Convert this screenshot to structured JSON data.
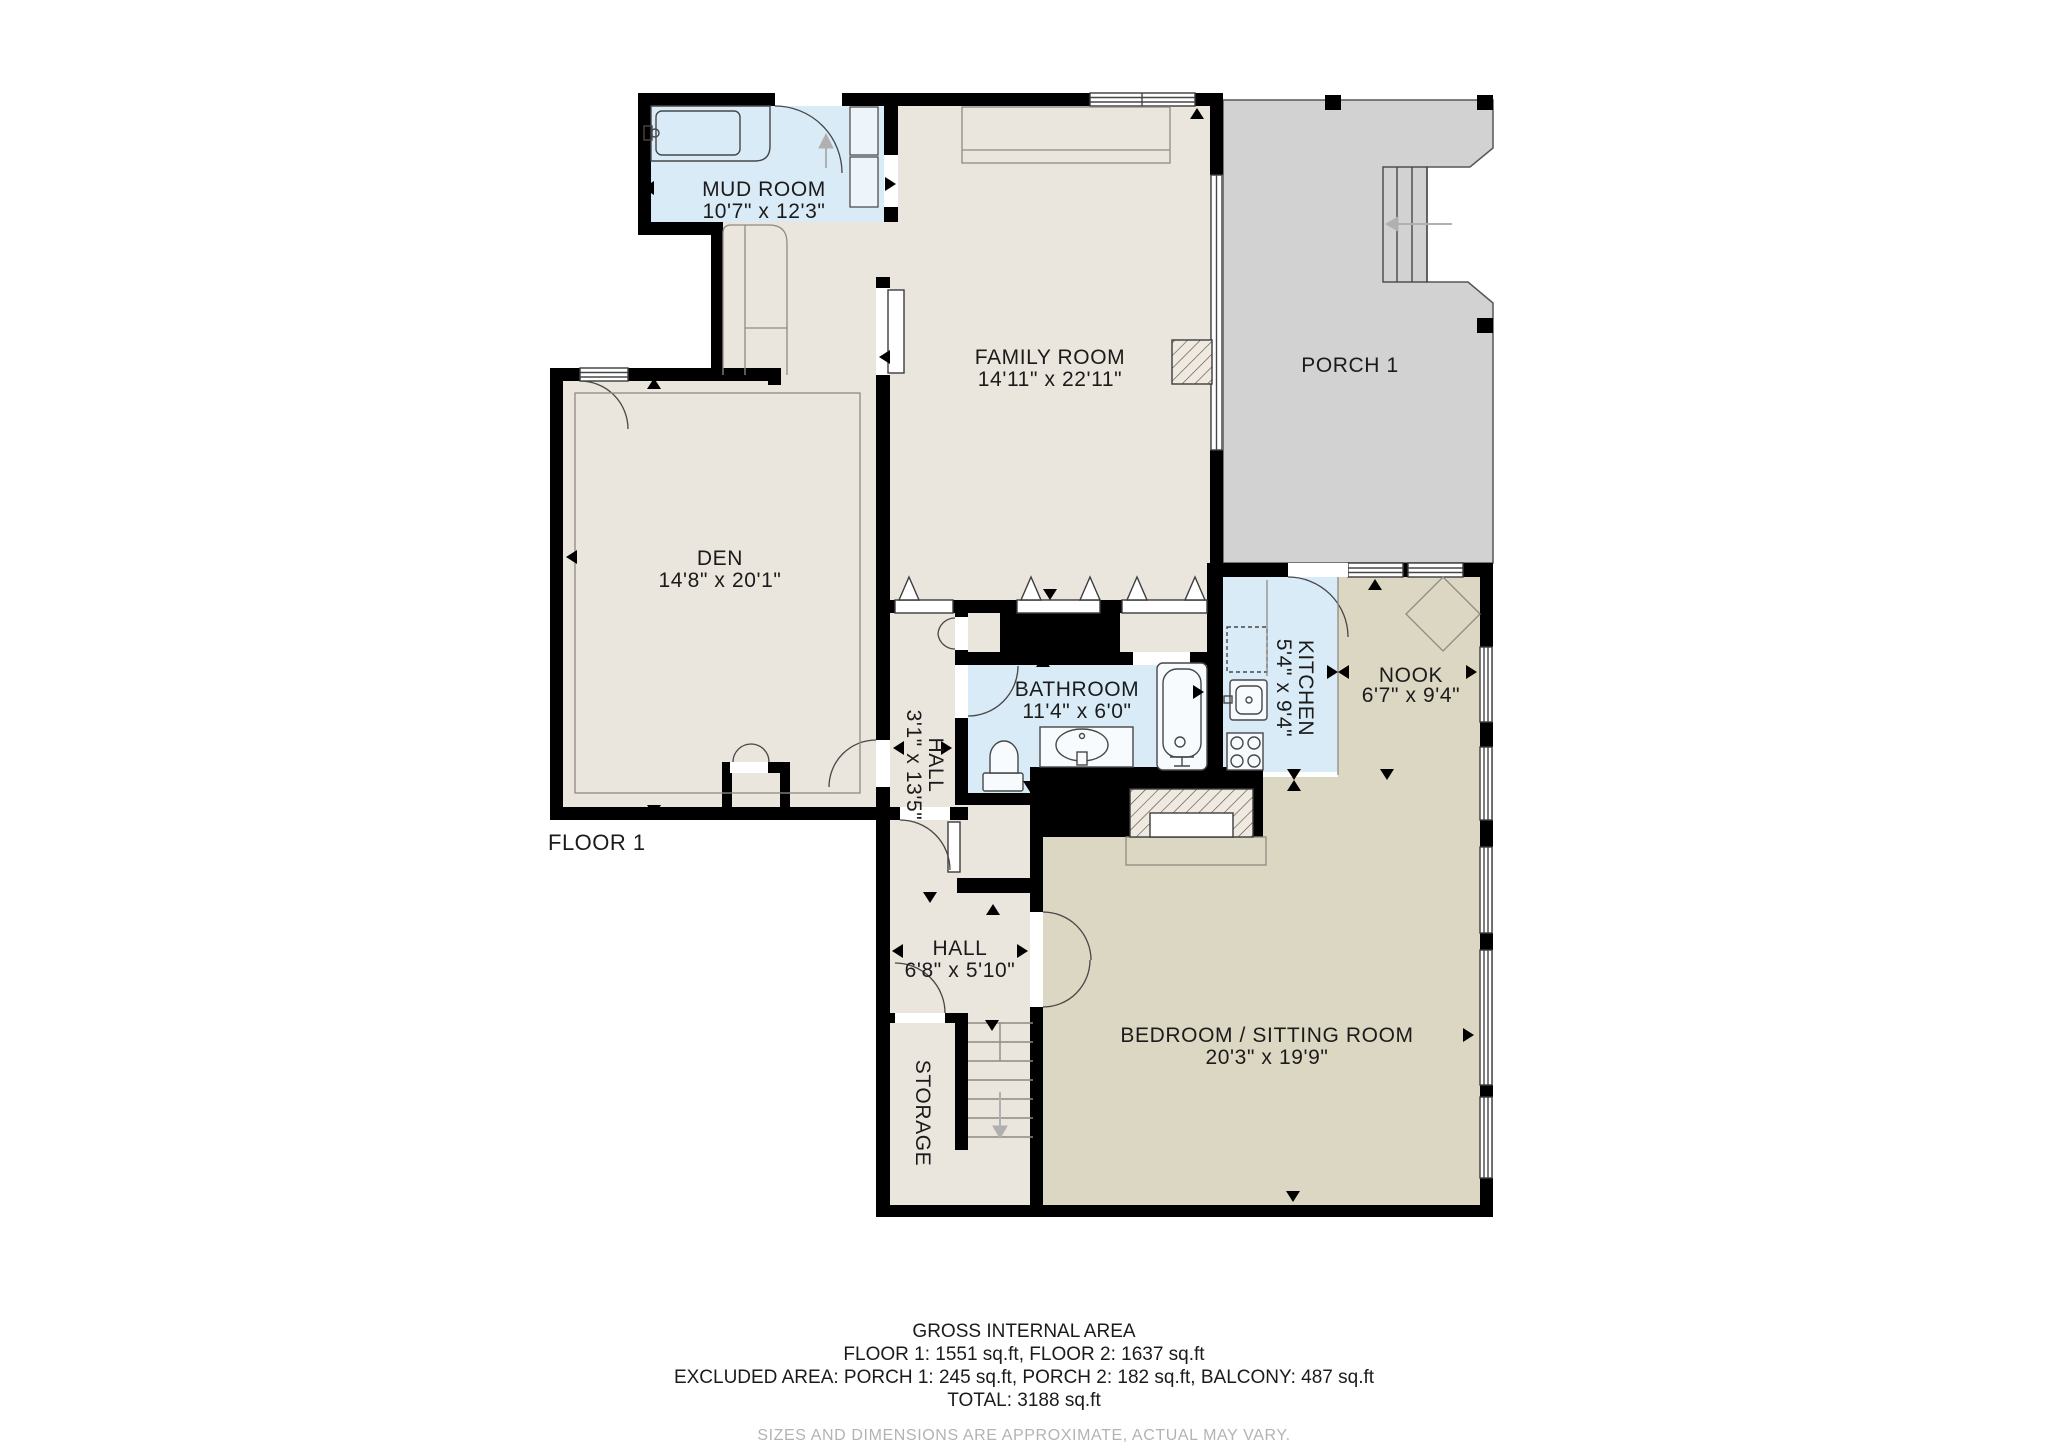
{
  "floor_label": "FLOOR 1",
  "rooms": {
    "mud_room": {
      "name": "MUD ROOM",
      "dims": "10'7\" x 12'3\""
    },
    "family_room": {
      "name": "FAMILY ROOM",
      "dims": "14'11\" x 22'11\""
    },
    "porch": {
      "name": "PORCH 1"
    },
    "den": {
      "name": "DEN",
      "dims": "14'8\" x 20'1\""
    },
    "hall_upper": {
      "name": "HALL",
      "dims": "3'1\" x 13'5\""
    },
    "bathroom": {
      "name": "BATHROOM",
      "dims": "11'4\" x 6'0\""
    },
    "kitchen": {
      "name": "KITCHEN",
      "dims": "5'4\" x 9'4\""
    },
    "nook": {
      "name": "NOOK",
      "dims": "6'7\" x 9'4\""
    },
    "hall_lower": {
      "name": "HALL",
      "dims": "6'8\" x 5'10\""
    },
    "bedroom": {
      "name": "BEDROOM / SITTING ROOM",
      "dims": "20'3\" x 19'9\""
    },
    "storage": {
      "name": "STORAGE"
    }
  },
  "footer": {
    "title": "GROSS INTERNAL AREA",
    "line1": "FLOOR 1: 1551 sq.ft, FLOOR 2: 1637 sq.ft",
    "line2": "EXCLUDED AREA: PORCH 1: 245 sq.ft, PORCH 2: 182 sq.ft, BALCONY: 487 sq.ft",
    "line3": "TOTAL: 3188 sq.ft",
    "disclaimer": "SIZES AND DIMENSIONS ARE APPROXIMATE, ACTUAL MAY VARY."
  },
  "colors": {
    "wall": "#000000",
    "room_beige": "#eae5dd",
    "room_blue": "#d9ebf7",
    "room_tan": "#dcd7c2",
    "porch_gray": "#d2d2d3",
    "closet_light": "#eef5fa",
    "label": "#1b1b1b",
    "muted": "#b3b3b3"
  }
}
